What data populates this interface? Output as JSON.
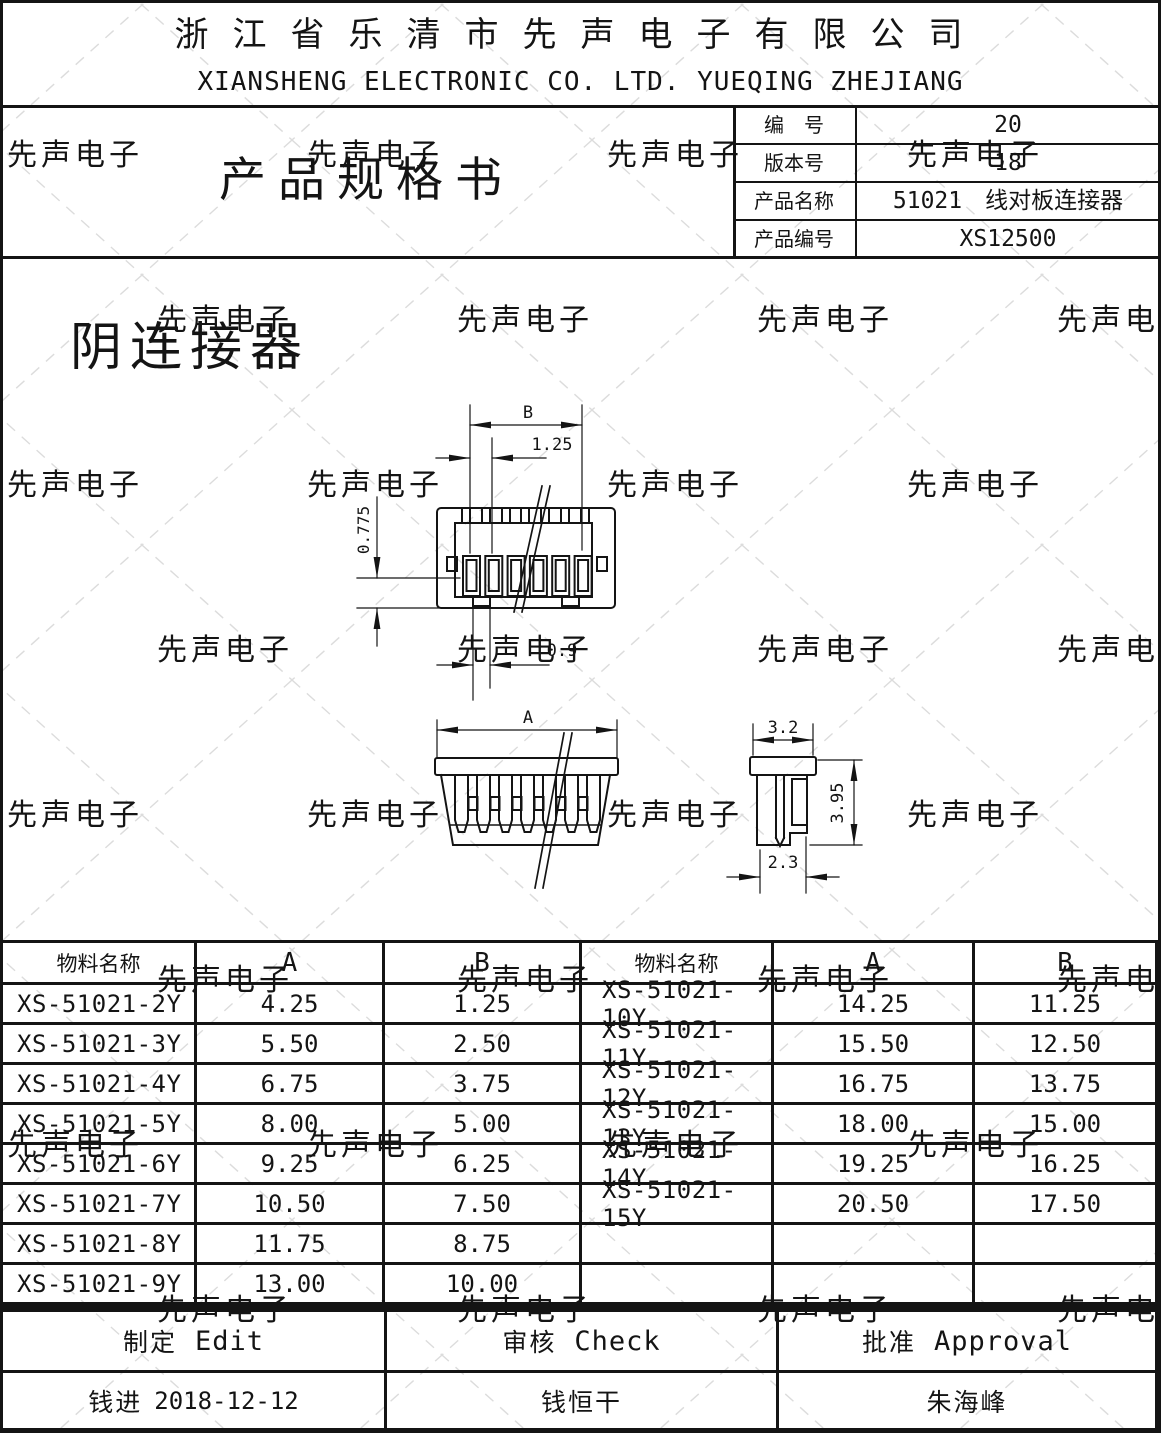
{
  "watermark": {
    "text": "先声电子"
  },
  "header": {
    "company_cn": "浙江省乐清市先声电子有限公司",
    "company_en": "XIANSHENG ELECTRONIC CO. LTD. YUEQING ZHEJIANG"
  },
  "title_block": {
    "doc_title": "产品规格书",
    "rows": [
      {
        "label": "编　号",
        "value": "20"
      },
      {
        "label": "版本号",
        "value": "18"
      },
      {
        "label": "产品名称",
        "value": "51021　线对板连接器"
      },
      {
        "label": "产品编号",
        "value": "XS12500"
      }
    ]
  },
  "drawing": {
    "section_label": "阴连接器",
    "dims": {
      "b": "B",
      "pitch": "1.25",
      "depth": "0.775",
      "slot": "0.9",
      "a": "A",
      "side_width": "3.2",
      "side_height": "3.95",
      "side_base": "2.3"
    }
  },
  "table": {
    "headers": [
      "物料名称",
      "A",
      "B",
      "物料名称",
      "A",
      "B"
    ],
    "rows": [
      [
        "XS-51021-2Y",
        "4.25",
        "1.25",
        "XS-51021-10Y",
        "14.25",
        "11.25"
      ],
      [
        "XS-51021-3Y",
        "5.50",
        "2.50",
        "XS-51021-11Y",
        "15.50",
        "12.50"
      ],
      [
        "XS-51021-4Y",
        "6.75",
        "3.75",
        "XS-51021-12Y",
        "16.75",
        "13.75"
      ],
      [
        "XS-51021-5Y",
        "8.00",
        "5.00",
        "XS-51021-13Y",
        "18.00",
        "15.00"
      ],
      [
        "XS-51021-6Y",
        "9.25",
        "6.25",
        "XS-51021-14Y",
        "19.25",
        "16.25"
      ],
      [
        "XS-51021-7Y",
        "10.50",
        "7.50",
        "XS-51021-15Y",
        "20.50",
        "17.50"
      ],
      [
        "XS-51021-8Y",
        "11.75",
        "8.75",
        "",
        "",
        ""
      ],
      [
        "XS-51021-9Y",
        "13.00",
        "10.00",
        "",
        "",
        ""
      ]
    ]
  },
  "footer": {
    "sign": [
      {
        "cn": "制定",
        "en": "Edit"
      },
      {
        "cn": "审核",
        "en": "Check"
      },
      {
        "cn": "批准",
        "en": "Approval"
      }
    ],
    "names": [
      {
        "cn": "钱进",
        "date": "2018-12-12"
      },
      {
        "cn": "钱恒干",
        "date": ""
      },
      {
        "cn": "朱海峰",
        "date": ""
      }
    ]
  }
}
